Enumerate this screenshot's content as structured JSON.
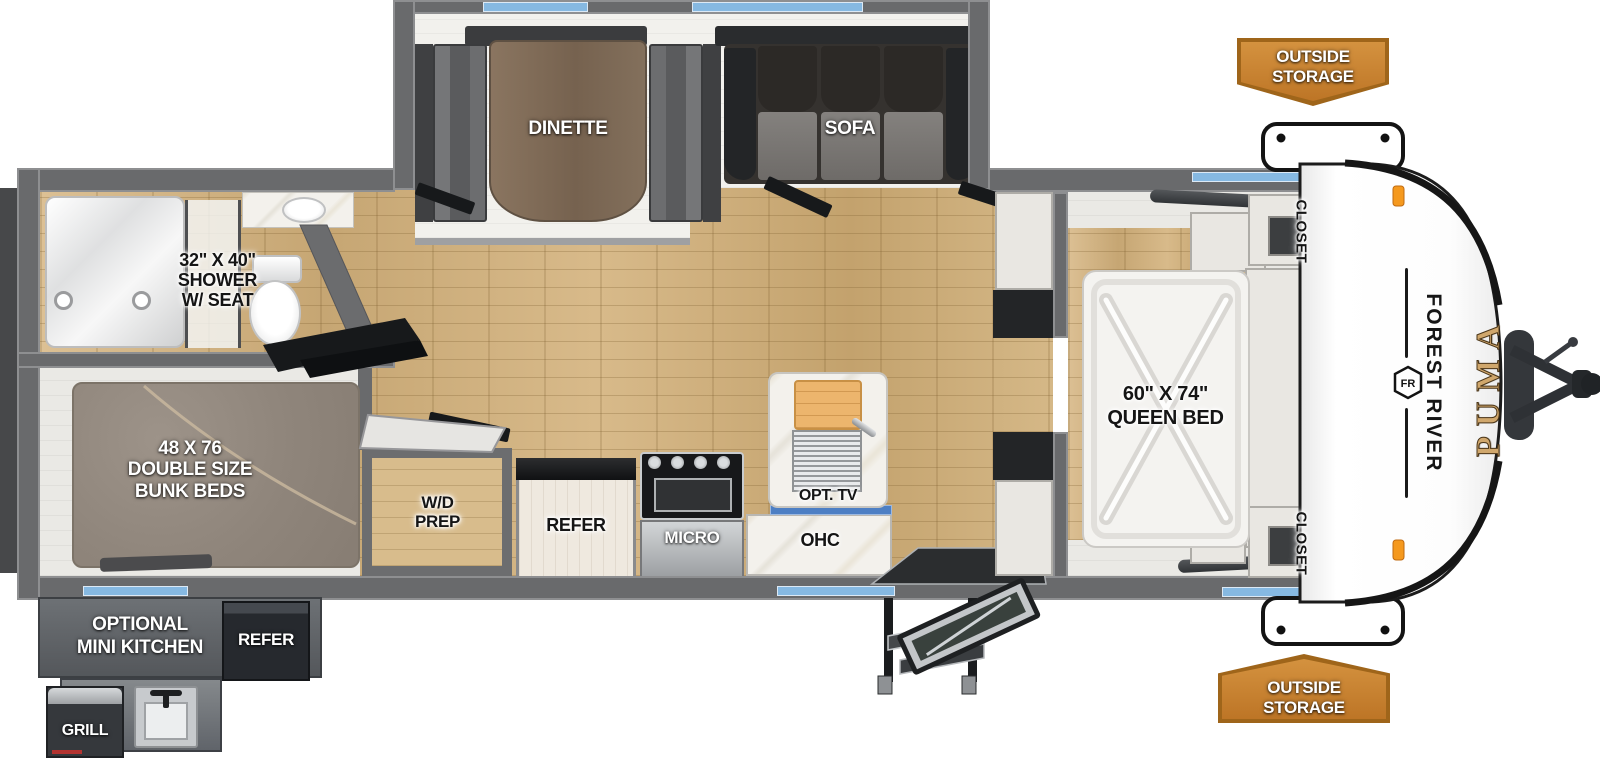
{
  "brand": {
    "manufacturer": "FOREST RIVER",
    "model": "PUMA",
    "logo_monogram": "FR"
  },
  "rooms": {
    "dinette": "DINETTE",
    "sofa": "SOFA",
    "shower": {
      "l1": "32\" X 40\"",
      "l2": "SHOWER",
      "l3": "W/ SEAT"
    },
    "bunks": {
      "l1": "48 X 76",
      "l2": "DOUBLE SIZE",
      "l3": "BUNK BEDS"
    },
    "wd_prep": {
      "l1": "W/D",
      "l2": "PREP"
    },
    "refer": "REFER",
    "micro": "MICRO",
    "ohc": "OHC",
    "opt_tv": "OPT. TV",
    "queen_bed": {
      "l1": "60\" X 74\"",
      "l2": "QUEEN BED"
    },
    "closet_top": "CLOSET",
    "closet_bottom": "CLOSET"
  },
  "exterior": {
    "outside_storage_top": {
      "l1": "OUTSIDE",
      "l2": "STORAGE"
    },
    "outside_storage_bottom": {
      "l1": "OUTSIDE",
      "l2": "STORAGE"
    },
    "mini_kitchen": {
      "l1": "OPTIONAL",
      "l2": "MINI KITCHEN"
    },
    "refer": "REFER",
    "grill": "GRILL"
  },
  "colors": {
    "accent_orange": "#c5822f",
    "orange_border": "#9f651a",
    "window_blue": "#86b9e2",
    "wall_gray": "#696a6c",
    "floor_wood": "#d2b485",
    "brand_gold": "#d0a76c"
  }
}
